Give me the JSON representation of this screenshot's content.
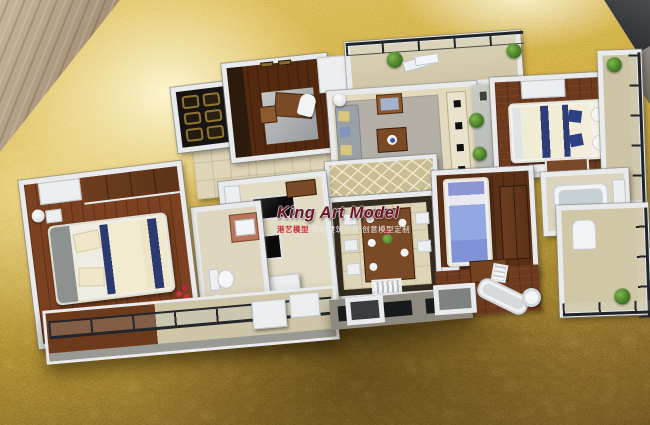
{
  "watermark": {
    "title": "King Art Model",
    "subtitle_red": "港艺模型",
    "subtitle_white": "高端建筑沙盘 创意模型定制"
  },
  "palette": {
    "gold_highlight": "#f8eeb8",
    "gold_mid": "#c9a23f",
    "gold_shadow": "#6a5121",
    "wall_white": "#e8eaec",
    "wood_floor_dark": "#6b3a1d",
    "navy_bedding": "#2c3a72",
    "blue_bed_duvet": "#8fa3de",
    "railing_black": "#202428",
    "table_wood_corner": "#b5a084",
    "backdrop_dark_corner": "#2f3134",
    "watermark_red": "#6d1322"
  }
}
